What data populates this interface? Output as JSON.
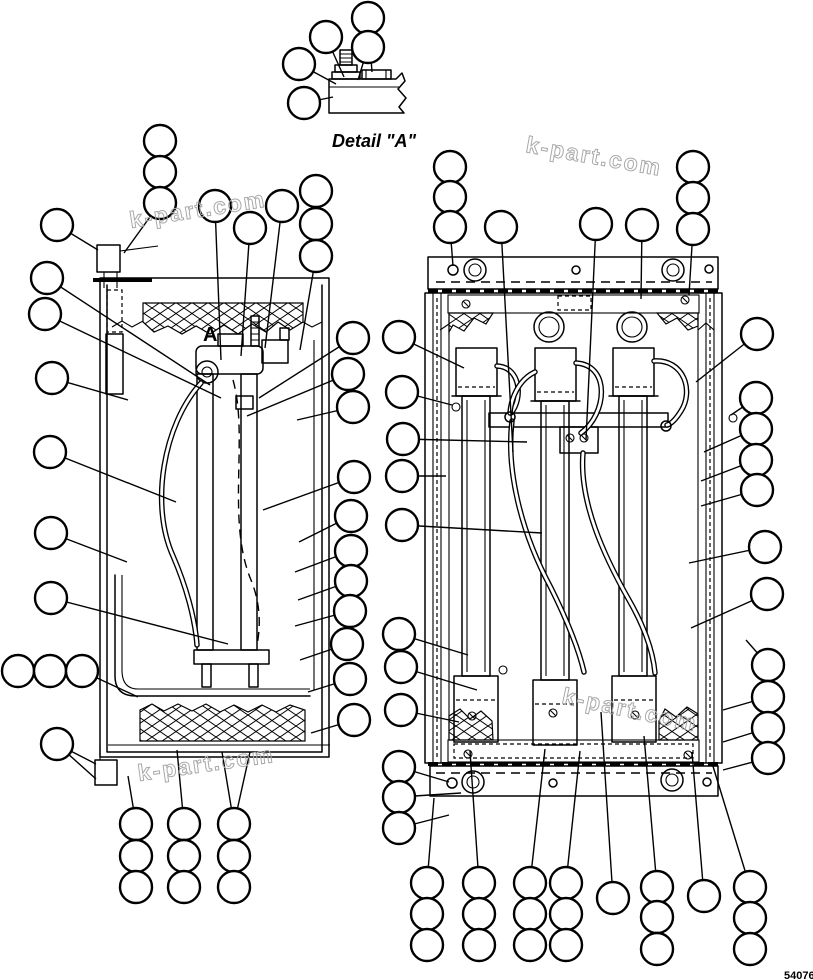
{
  "page": {
    "background": "#ffffff",
    "ink": "#000000",
    "watermark_color": "#a9a9a9"
  },
  "labels": {
    "detail_a": "Detail \"A\"",
    "section_marker": "A",
    "figure_number": "54076"
  },
  "watermarks": [
    {
      "text": "k-part.com",
      "x": 525,
      "y": 152,
      "rotation": 10
    },
    {
      "text": "k-part.com",
      "x": 131,
      "y": 228,
      "rotation": -9
    },
    {
      "text": "k-part.com",
      "x": 139,
      "y": 781,
      "rotation": -8
    },
    {
      "text": "k-part.com",
      "x": 561,
      "y": 703,
      "rotation": 12
    }
  ],
  "callouts": [
    {
      "x": 368,
      "y": 18,
      "l": [
        [
          372,
          72
        ]
      ]
    },
    {
      "x": 326,
      "y": 37,
      "l": [
        [
          344,
          77
        ]
      ]
    },
    {
      "x": 368,
      "y": 47,
      "l": [
        [
          358,
          80
        ]
      ]
    },
    {
      "x": 299,
      "y": 64,
      "l": [
        [
          336,
          84
        ]
      ]
    },
    {
      "x": 304,
      "y": 103,
      "l": [
        [
          333,
          97
        ]
      ]
    },
    {
      "x": 160,
      "y": 141,
      "l": []
    },
    {
      "x": 160,
      "y": 172,
      "l": []
    },
    {
      "x": 160,
      "y": 203,
      "l": [
        [
          124,
          253
        ]
      ]
    },
    {
      "x": 57,
      "y": 225,
      "l": [
        [
          98,
          250
        ]
      ]
    },
    {
      "x": 47,
      "y": 278,
      "l": [
        [
          210,
          385
        ]
      ]
    },
    {
      "x": 45,
      "y": 314,
      "l": [
        [
          221,
          398
        ]
      ]
    },
    {
      "x": 52,
      "y": 378,
      "l": [
        [
          128,
          400
        ]
      ]
    },
    {
      "x": 50,
      "y": 452,
      "l": [
        [
          176,
          502
        ]
      ]
    },
    {
      "x": 51,
      "y": 533,
      "l": [
        [
          127,
          562
        ]
      ]
    },
    {
      "x": 51,
      "y": 598,
      "l": [
        [
          228,
          644
        ]
      ]
    },
    {
      "x": 18,
      "y": 671,
      "l": []
    },
    {
      "x": 50,
      "y": 671,
      "l": []
    },
    {
      "x": 82,
      "y": 671,
      "l": [
        [
          138,
          697
        ]
      ]
    },
    {
      "x": 57,
      "y": 744,
      "l": [
        [
          96,
          764
        ],
        [
          96,
          779
        ]
      ]
    },
    {
      "x": 136,
      "y": 824,
      "l": [
        [
          128,
          776
        ]
      ]
    },
    {
      "x": 136,
      "y": 856,
      "l": []
    },
    {
      "x": 136,
      "y": 887,
      "l": []
    },
    {
      "x": 184,
      "y": 824,
      "l": [
        [
          177,
          750
        ]
      ]
    },
    {
      "x": 184,
      "y": 856,
      "l": []
    },
    {
      "x": 184,
      "y": 887,
      "l": []
    },
    {
      "x": 234,
      "y": 824,
      "l": [
        [
          222,
          752
        ],
        [
          250,
          752
        ]
      ]
    },
    {
      "x": 234,
      "y": 856,
      "l": []
    },
    {
      "x": 234,
      "y": 887,
      "l": []
    },
    {
      "x": 215,
      "y": 206,
      "l": [
        [
          221,
          360
        ]
      ]
    },
    {
      "x": 250,
      "y": 228,
      "l": [
        [
          241,
          356
        ]
      ]
    },
    {
      "x": 282,
      "y": 206,
      "l": [
        [
          265,
          348
        ]
      ]
    },
    {
      "x": 316,
      "y": 191,
      "l": []
    },
    {
      "x": 316,
      "y": 224,
      "l": []
    },
    {
      "x": 316,
      "y": 256,
      "l": [
        [
          300,
          350
        ]
      ]
    },
    {
      "x": 353,
      "y": 338,
      "l": [
        [
          259,
          398
        ]
      ]
    },
    {
      "x": 348,
      "y": 374,
      "l": [
        [
          247,
          416
        ]
      ]
    },
    {
      "x": 353,
      "y": 407,
      "l": [
        [
          297,
          420
        ]
      ]
    },
    {
      "x": 354,
      "y": 477,
      "l": [
        [
          263,
          510
        ]
      ]
    },
    {
      "x": 351,
      "y": 516,
      "l": [
        [
          299,
          542
        ]
      ]
    },
    {
      "x": 351,
      "y": 551,
      "l": [
        [
          295,
          572
        ]
      ]
    },
    {
      "x": 351,
      "y": 581,
      "l": [
        [
          298,
          600
        ]
      ]
    },
    {
      "x": 350,
      "y": 611,
      "l": [
        [
          295,
          626
        ]
      ]
    },
    {
      "x": 347,
      "y": 644,
      "l": [
        [
          300,
          660
        ]
      ]
    },
    {
      "x": 350,
      "y": 679,
      "l": [
        [
          308,
          692
        ]
      ]
    },
    {
      "x": 354,
      "y": 720,
      "l": [
        [
          311,
          733
        ]
      ]
    },
    {
      "x": 450,
      "y": 167,
      "l": []
    },
    {
      "x": 450,
      "y": 197,
      "l": []
    },
    {
      "x": 450,
      "y": 227,
      "l": [
        [
          453,
          266
        ]
      ]
    },
    {
      "x": 501,
      "y": 227,
      "l": [
        [
          513,
          452
        ]
      ]
    },
    {
      "x": 596,
      "y": 224,
      "l": [
        [
          586,
          440
        ]
      ]
    },
    {
      "x": 642,
      "y": 225,
      "l": [
        [
          641,
          299
        ]
      ]
    },
    {
      "x": 693,
      "y": 167,
      "l": []
    },
    {
      "x": 693,
      "y": 198,
      "l": []
    },
    {
      "x": 693,
      "y": 229,
      "l": [
        [
          689,
          295
        ]
      ]
    },
    {
      "x": 399,
      "y": 337,
      "l": [
        [
          464,
          368
        ]
      ]
    },
    {
      "x": 402,
      "y": 392,
      "l": [
        [
          452,
          405
        ]
      ]
    },
    {
      "x": 403,
      "y": 439,
      "l": [
        [
          527,
          442
        ]
      ]
    },
    {
      "x": 402,
      "y": 476,
      "l": [
        [
          446,
          476
        ]
      ]
    },
    {
      "x": 402,
      "y": 525,
      "l": [
        [
          542,
          533
        ]
      ]
    },
    {
      "x": 399,
      "y": 634,
      "l": [
        [
          468,
          655
        ]
      ]
    },
    {
      "x": 401,
      "y": 667,
      "l": [
        [
          477,
          690
        ]
      ]
    },
    {
      "x": 401,
      "y": 710,
      "l": [
        [
          459,
          722
        ]
      ]
    },
    {
      "x": 399,
      "y": 767,
      "l": [
        [
          449,
          782
        ]
      ]
    },
    {
      "x": 399,
      "y": 797,
      "l": [
        [
          461,
          793
        ]
      ]
    },
    {
      "x": 399,
      "y": 828,
      "l": [
        [
          449,
          815
        ]
      ]
    },
    {
      "x": 757,
      "y": 334,
      "l": [
        [
          696,
          382
        ]
      ]
    },
    {
      "x": 756,
      "y": 398,
      "l": [
        [
          731,
          415
        ]
      ]
    },
    {
      "x": 756,
      "y": 429,
      "l": [
        [
          704,
          452
        ]
      ]
    },
    {
      "x": 756,
      "y": 460,
      "l": [
        [
          701,
          481
        ]
      ]
    },
    {
      "x": 757,
      "y": 490,
      "l": [
        [
          701,
          506
        ]
      ]
    },
    {
      "x": 765,
      "y": 547,
      "l": [
        [
          689,
          563
        ]
      ]
    },
    {
      "x": 767,
      "y": 594,
      "l": [
        [
          691,
          628
        ]
      ]
    },
    {
      "x": 768,
      "y": 665,
      "l": [
        [
          746,
          640
        ]
      ]
    },
    {
      "x": 768,
      "y": 697,
      "l": [
        [
          723,
          710
        ]
      ]
    },
    {
      "x": 768,
      "y": 728,
      "l": [
        [
          723,
          742
        ]
      ]
    },
    {
      "x": 768,
      "y": 758,
      "l": [
        [
          723,
          770
        ]
      ]
    },
    {
      "x": 427,
      "y": 883,
      "l": [
        [
          434,
          798
        ]
      ]
    },
    {
      "x": 427,
      "y": 914,
      "l": []
    },
    {
      "x": 427,
      "y": 945,
      "l": []
    },
    {
      "x": 479,
      "y": 883,
      "l": [
        [
          470,
          751
        ]
      ]
    },
    {
      "x": 479,
      "y": 914,
      "l": []
    },
    {
      "x": 479,
      "y": 945,
      "l": []
    },
    {
      "x": 530,
      "y": 883,
      "l": [
        [
          545,
          749
        ]
      ]
    },
    {
      "x": 530,
      "y": 914,
      "l": []
    },
    {
      "x": 530,
      "y": 945,
      "l": []
    },
    {
      "x": 566,
      "y": 883,
      "l": [
        [
          580,
          751
        ]
      ]
    },
    {
      "x": 566,
      "y": 914,
      "l": []
    },
    {
      "x": 566,
      "y": 945,
      "l": []
    },
    {
      "x": 613,
      "y": 898,
      "l": [
        [
          601,
          712
        ]
      ]
    },
    {
      "x": 657,
      "y": 887,
      "l": [
        [
          644,
          736
        ]
      ]
    },
    {
      "x": 657,
      "y": 917,
      "l": []
    },
    {
      "x": 657,
      "y": 949,
      "l": []
    },
    {
      "x": 704,
      "y": 896,
      "l": [
        [
          692,
          752
        ]
      ]
    },
    {
      "x": 750,
      "y": 887,
      "l": [
        [
          712,
          763
        ]
      ]
    },
    {
      "x": 750,
      "y": 918,
      "l": []
    },
    {
      "x": 750,
      "y": 949,
      "l": []
    }
  ],
  "balloon_radius": 16
}
